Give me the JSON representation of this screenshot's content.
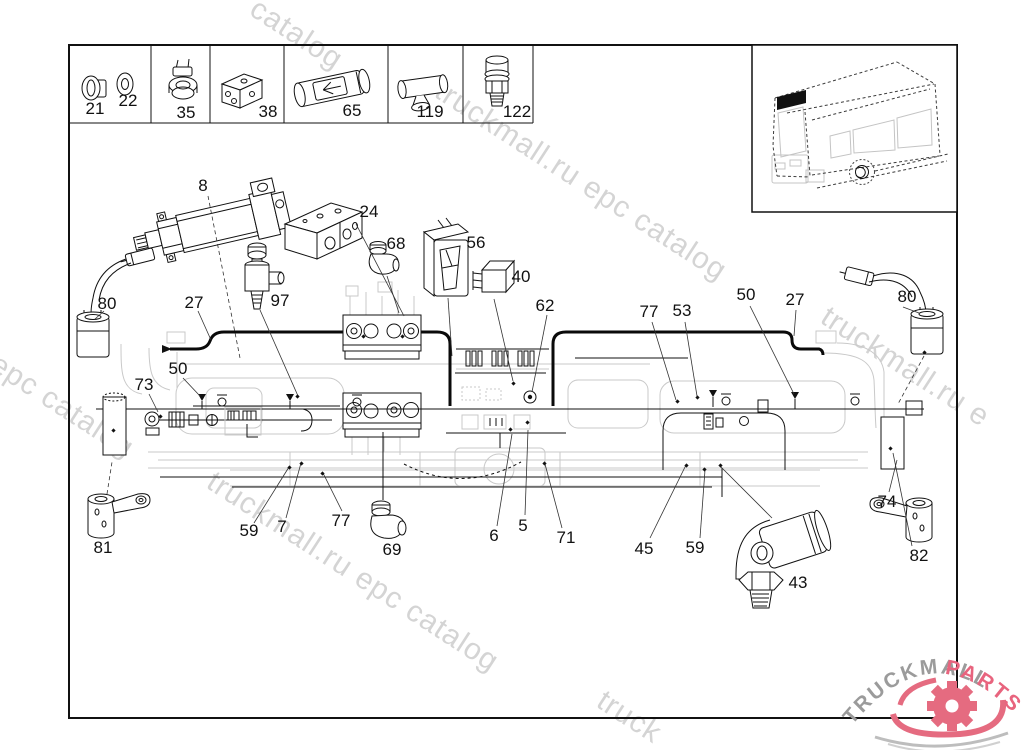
{
  "watermark_color": "#d4d4d4",
  "watermarks": [
    {
      "text": "catalog",
      "x": 262,
      "y": -8,
      "angle": 33
    },
    {
      "text": "truckmall.ru epc catalog",
      "x": 447,
      "y": 74,
      "angle": 33
    },
    {
      "text": "truckmall.ru e",
      "x": 833,
      "y": 300,
      "angle": 33
    },
    {
      "text": "l epc catalog",
      "x": -12,
      "y": 338,
      "angle": 33
    },
    {
      "text": "truckmall.ru epc catalog",
      "x": 219,
      "y": 465,
      "angle": 33
    },
    {
      "text": "truck",
      "x": 609,
      "y": 684,
      "angle": 33
    }
  ],
  "legend": {
    "items": [
      {
        "number": "21",
        "x": 95,
        "y": 109
      },
      {
        "number": "22",
        "x": 128,
        "y": 101
      },
      {
        "number": "35",
        "x": 186,
        "y": 113
      },
      {
        "number": "38",
        "x": 268,
        "y": 112
      },
      {
        "number": "65",
        "x": 352,
        "y": 111
      },
      {
        "number": "119",
        "x": 430,
        "y": 112
      },
      {
        "number": "122",
        "x": 517,
        "y": 112
      }
    ]
  },
  "callouts": [
    {
      "number": "8",
      "x": 203,
      "y": 186
    },
    {
      "number": "24",
      "x": 369,
      "y": 212
    },
    {
      "number": "68",
      "x": 396,
      "y": 244
    },
    {
      "number": "56",
      "x": 476,
      "y": 243
    },
    {
      "number": "40",
      "x": 521,
      "y": 277
    },
    {
      "number": "62",
      "x": 545,
      "y": 306
    },
    {
      "number": "80",
      "x": 107,
      "y": 304
    },
    {
      "number": "27",
      "x": 194,
      "y": 303
    },
    {
      "number": "97",
      "x": 280,
      "y": 301
    },
    {
      "number": "50",
      "x": 178,
      "y": 369
    },
    {
      "number": "73",
      "x": 144,
      "y": 385
    },
    {
      "number": "59",
      "x": 249,
      "y": 531
    },
    {
      "number": "7",
      "x": 282,
      "y": 527
    },
    {
      "number": "77",
      "x": 341,
      "y": 521
    },
    {
      "number": "69",
      "x": 392,
      "y": 550
    },
    {
      "number": "6",
      "x": 494,
      "y": 536
    },
    {
      "number": "5",
      "x": 523,
      "y": 526
    },
    {
      "number": "71",
      "x": 566,
      "y": 538
    },
    {
      "number": "45",
      "x": 644,
      "y": 549
    },
    {
      "number": "59",
      "x": 695,
      "y": 548
    },
    {
      "number": "43",
      "x": 798,
      "y": 583
    },
    {
      "number": "77",
      "x": 649,
      "y": 312
    },
    {
      "number": "53",
      "x": 682,
      "y": 311
    },
    {
      "number": "50",
      "x": 746,
      "y": 295
    },
    {
      "number": "27",
      "x": 795,
      "y": 300
    },
    {
      "number": "80",
      "x": 907,
      "y": 297
    },
    {
      "number": "74",
      "x": 887,
      "y": 502
    },
    {
      "number": "81",
      "x": 103,
      "y": 548
    },
    {
      "number": "82",
      "x": 919,
      "y": 556
    }
  ],
  "logo": {
    "brand": "TRUCKMALL",
    "suffix": "PARTS",
    "brand_color": "#9b9b9b",
    "suffix_color": "#e8647e",
    "gear_color": "#e56b80"
  },
  "colors": {
    "line": "#111111",
    "faint": "#c9c9c9",
    "highlight": "#000000"
  }
}
